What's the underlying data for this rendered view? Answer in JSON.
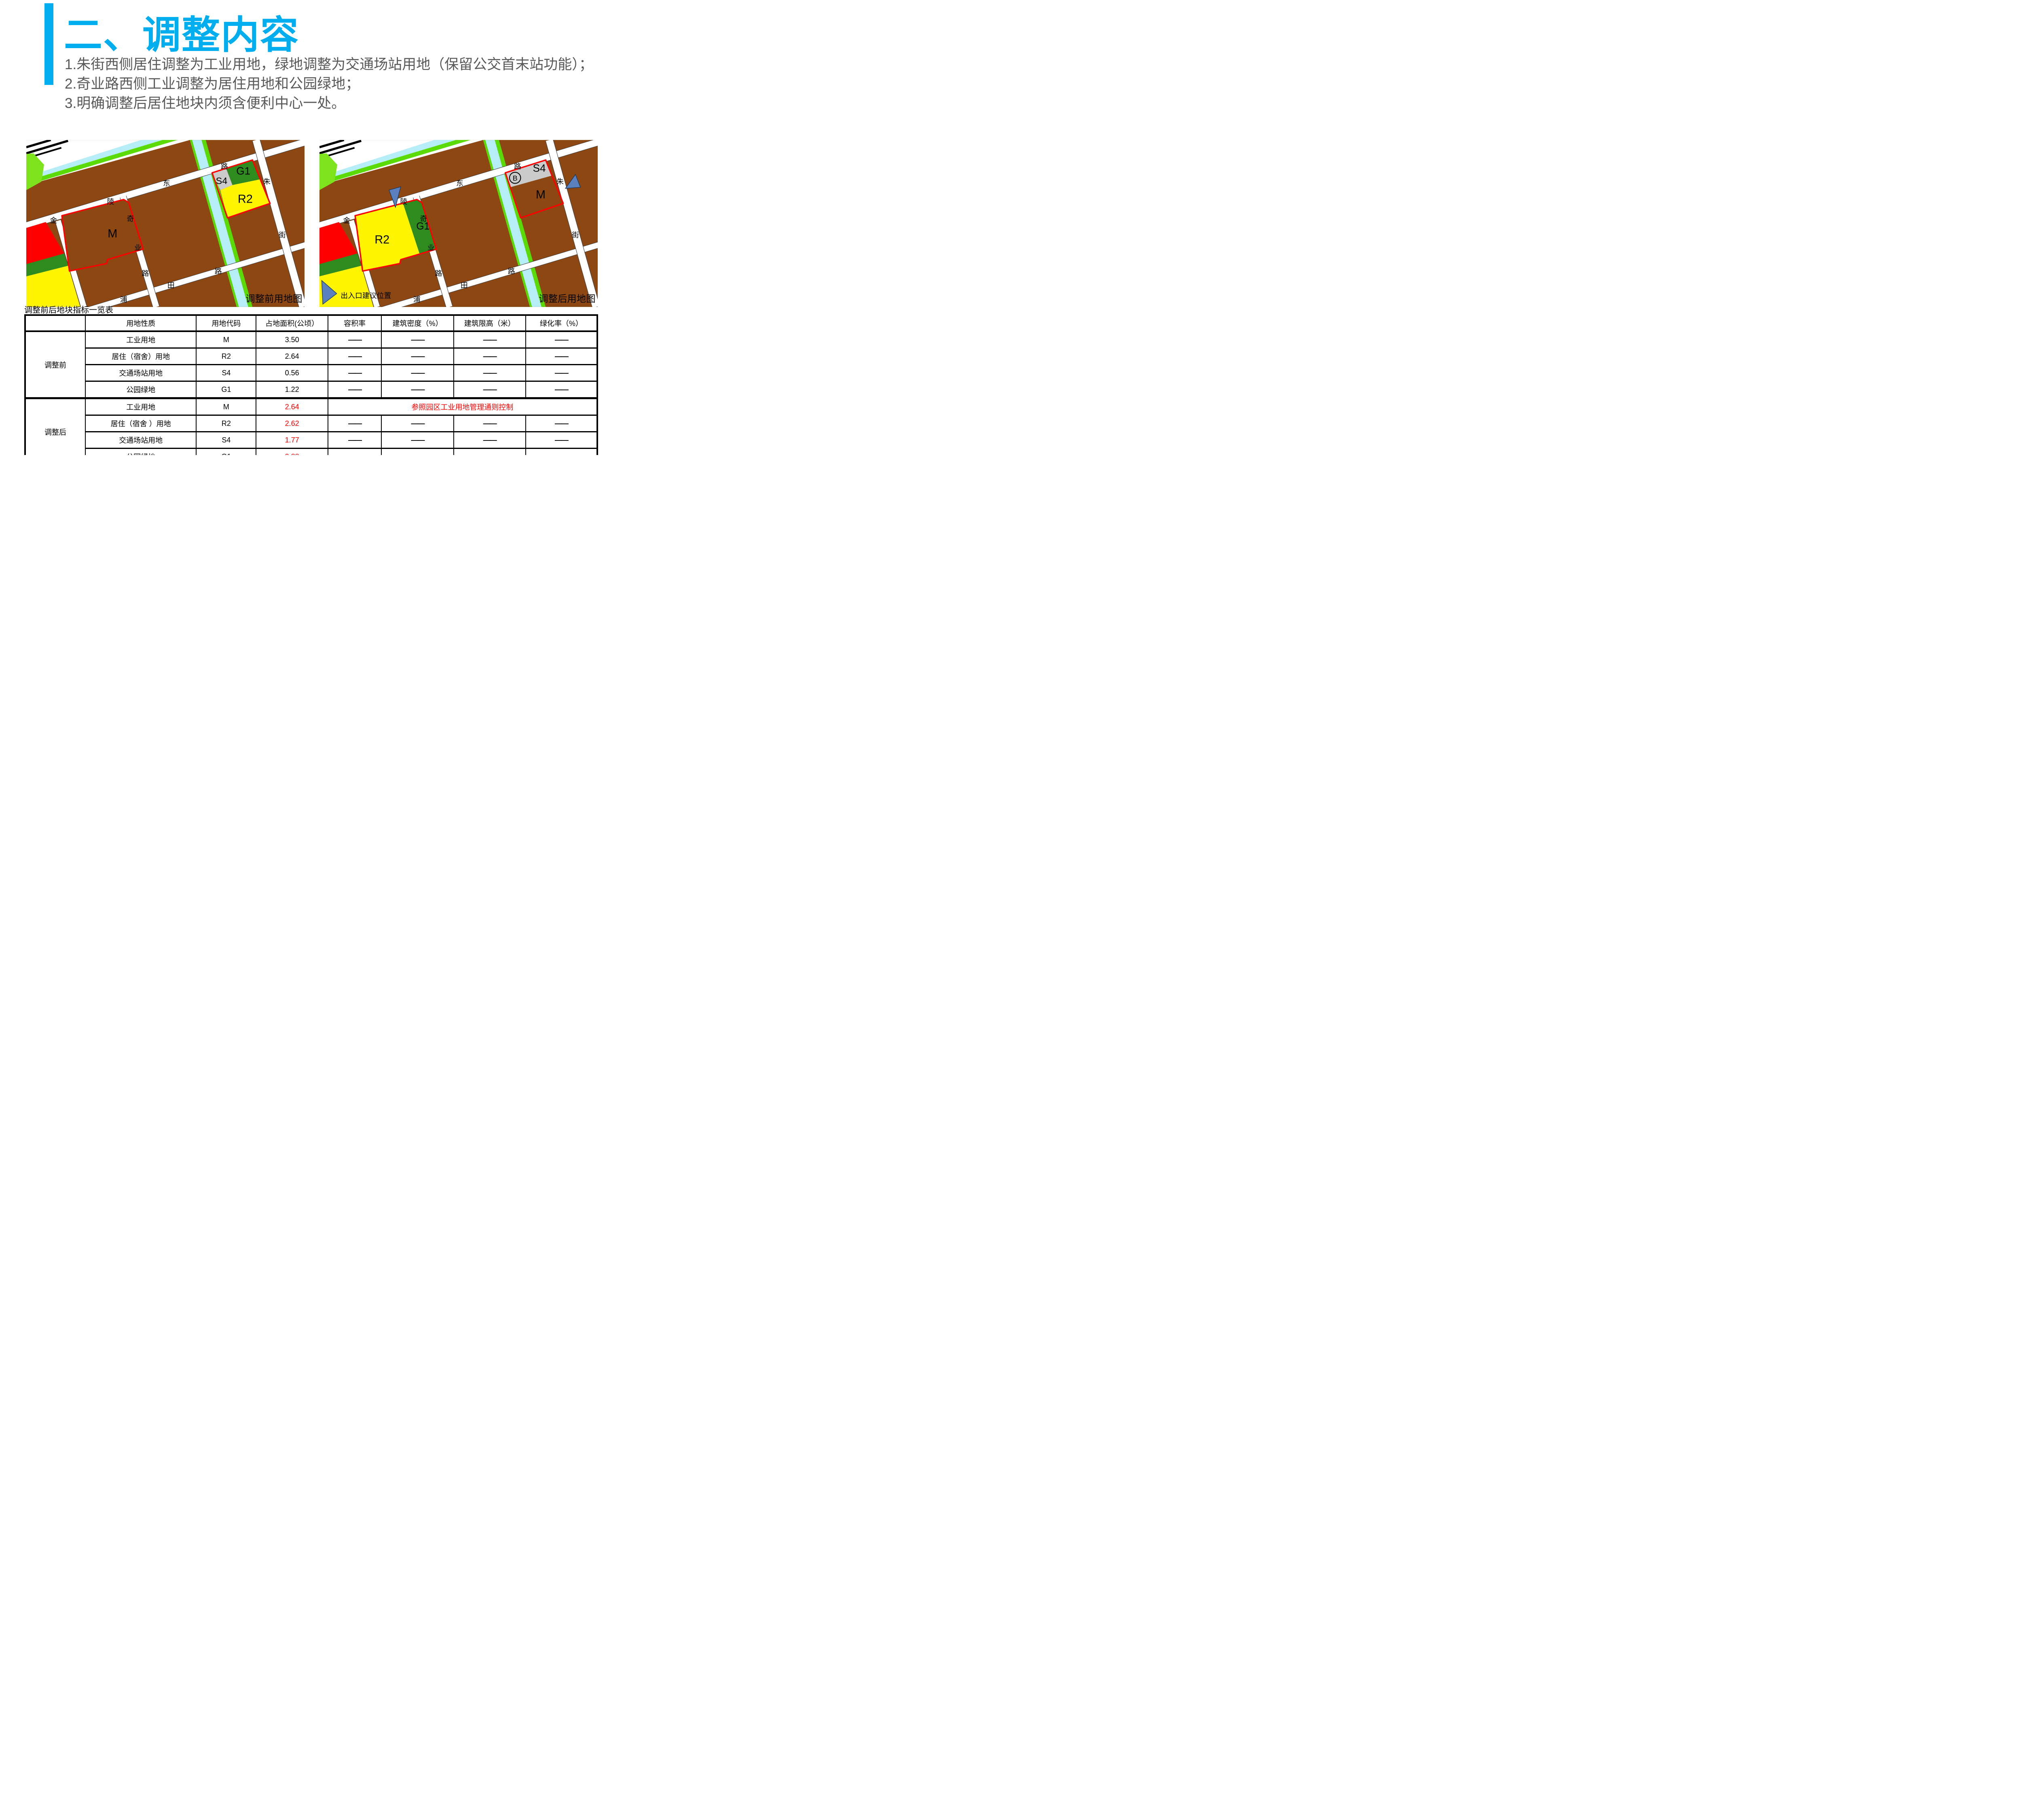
{
  "colors": {
    "accent": "#00AEEF",
    "body_text": "#595959",
    "map_brown": "#8C4713",
    "map_yellow": "#FFF500",
    "map_green_dark": "#2E8B1E",
    "map_gray": "#CBCBCB",
    "map_cyan": "#B5EEF7",
    "map_green_bright": "#5BDB05",
    "pentagon_green": "#7CE31C",
    "parcel_outline_red": "#FF0000",
    "arrow_blue": "#5B80BE",
    "table_red": "#FF0000"
  },
  "title": "二、调整内容",
  "body_lines": [
    "1.朱街西侧居住调整为工业用地，绿地调整为交通场站用地（保留公交首末站功能）；",
    "2.奇业路西侧工业调整为居住用地和公园绿地；",
    "3.明确调整后居住地块内须含便利中心一处。"
  ],
  "roads": {
    "jinling": [
      "金",
      "陵",
      "东",
      "路"
    ],
    "qiye": [
      "奇",
      "业",
      "路"
    ],
    "zhujie": [
      "朱",
      "街"
    ],
    "putian": [
      "浦",
      "田",
      "路"
    ]
  },
  "map_before": {
    "caption": "调整前用地图",
    "labels": {
      "m": "M",
      "r2": "R2",
      "g1": "G1",
      "s4": "S4"
    }
  },
  "map_after": {
    "caption": "调整后用地图",
    "labels": {
      "m": "M",
      "r2": "R2",
      "g1": "G1",
      "s4": "S4",
      "b": "B"
    },
    "legend": "出入口建议位置"
  },
  "table": {
    "title": "调整前后地块指标一览表",
    "dash": "——",
    "headers": [
      "",
      "用地性质",
      "用地代码",
      "占地面积(公顷）",
      "容积率",
      "建筑密度（%）",
      "建筑限高（米）",
      "绿化率（%）"
    ],
    "groups": [
      {
        "label": "调整前",
        "rows": [
          {
            "name": "工业用地",
            "code": "M",
            "area": "3.50"
          },
          {
            "name": "居住（宿舍）用地",
            "code": "R2",
            "area": "2.64"
          },
          {
            "name": "交通场站用地",
            "code": "S4",
            "area": "0.56"
          },
          {
            "name": "公园绿地",
            "code": "G1",
            "area": "1.22"
          }
        ]
      },
      {
        "label": "调整后",
        "note": "参照园区工业用地管理通则控制",
        "rows": [
          {
            "name": "工业用地",
            "code": "M",
            "area": "2.64"
          },
          {
            "name": "居住（宿舍 ）用地",
            "code": "R2",
            "area": "2.62"
          },
          {
            "name": "交通场站用地",
            "code": "S4",
            "area": "1.77"
          },
          {
            "name": "公园绿地",
            "code": "G1",
            "area": "0.88"
          }
        ]
      }
    ]
  }
}
